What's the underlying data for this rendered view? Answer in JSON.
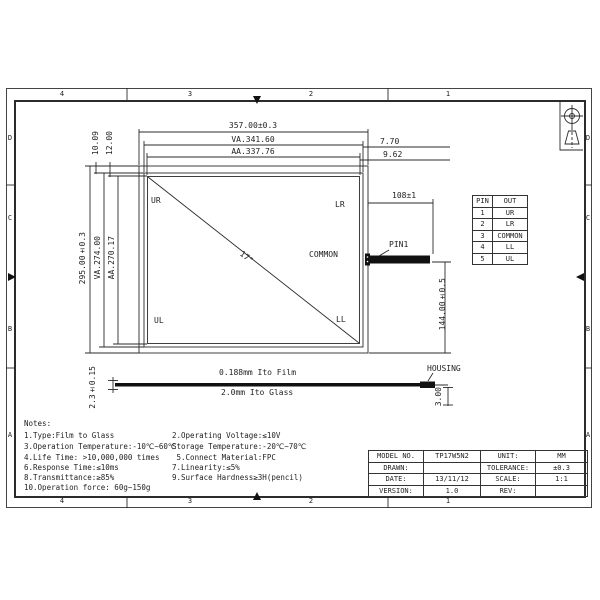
{
  "frame": {
    "top_zone_numbers": [
      "4",
      "3",
      "2",
      "1"
    ],
    "bottom_zone_numbers": [
      "4",
      "3",
      "2",
      "1"
    ],
    "left_zone_letters": [
      "D",
      "C",
      "B",
      "A"
    ],
    "right_zone_letters": [
      "D",
      "C",
      "B",
      "A"
    ]
  },
  "front_view": {
    "dim_width_total": "357.00±0.3",
    "dim_width_va": "VA.341.60",
    "dim_width_aa": "AA.337.76",
    "dim_top_va_offset": "10.09",
    "dim_top_aa_offset": "12.00",
    "dim_right_va_offset": "7.70",
    "dim_right_aa_offset": "9.62",
    "dim_height_total": "295.00±0.3",
    "dim_height_va": "VA.274.00",
    "dim_height_aa": "AA.270.17",
    "corner_labels": {
      "top_left": "UR",
      "top_right": "LR",
      "bottom_left": "UL",
      "bottom_right": "LL"
    },
    "common_label": "COMMON",
    "diagonal_size": "17\"",
    "pin1_label": "PIN1",
    "tail_length_dim": "108±1",
    "tail_position_dim": "144.00±0.5"
  },
  "pin_table": {
    "headers": [
      "PIN",
      "OUT"
    ],
    "rows": [
      [
        "1",
        "UR"
      ],
      [
        "2",
        "LR"
      ],
      [
        "3",
        "COMMON"
      ],
      [
        "4",
        "LL"
      ],
      [
        "5",
        "UL"
      ]
    ]
  },
  "side_view": {
    "film_label": "0.188mm Ito Film",
    "glass_label": "2.0mm Ito Glass",
    "thickness_dim": "2.3±0.15",
    "housing_label": "HOUSING",
    "housing_height_dim": "3.00"
  },
  "notes": {
    "title": "Notes:",
    "left": [
      "1.Type:Film to Glass",
      "3.Operation Temperature:-10℃~60℃",
      "4.Life Time: >10,000,000 times",
      "6.Response Time:≤10ms",
      "8.Transmittance:≥85%",
      "10.Operation force: 60g~150g"
    ],
    "right": [
      "2.Operating Voltage:≤10V",
      "Storage Temperature:-20℃~70℃",
      " 5.Connect Material:FPC",
      "7.Linearity:≤5%",
      "9.Surface Hardness≥3H(pencil)"
    ]
  },
  "title_block": {
    "rows": [
      [
        "MODEL NO.",
        "TP17W5N2",
        "UNIT:",
        "MM"
      ],
      [
        "DRAWN:",
        "",
        "TOLERANCE:",
        "±0.3"
      ],
      [
        "DATE:",
        "13/11/12",
        "SCALE:",
        "1:1"
      ],
      [
        "VERSION:",
        "1.0",
        "REV:",
        ""
      ]
    ]
  }
}
